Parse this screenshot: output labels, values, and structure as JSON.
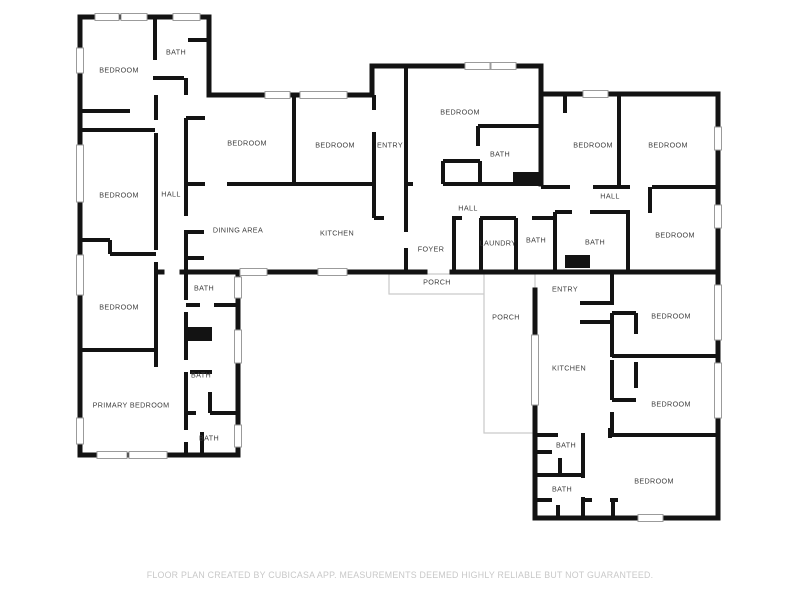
{
  "colors": {
    "wall": "#131313",
    "porch_outline": "#c9c9c9",
    "window_stroke": "#9b9b9b",
    "room_label": "#3d3d3d",
    "footer_text": "#c8c8c8"
  },
  "rooms": [
    {
      "label": "BEDROOM",
      "x": 119,
      "y": 70
    },
    {
      "label": "BATH",
      "x": 176,
      "y": 52
    },
    {
      "label": "BEDROOM",
      "x": 119,
      "y": 195
    },
    {
      "label": "HALL",
      "x": 171,
      "y": 194
    },
    {
      "label": "BEDROOM",
      "x": 247,
      "y": 143
    },
    {
      "label": "BEDROOM",
      "x": 335,
      "y": 145
    },
    {
      "label": "ENTRY",
      "x": 390,
      "y": 145
    },
    {
      "label": "BEDROOM",
      "x": 460,
      "y": 112
    },
    {
      "label": "BATH",
      "x": 500,
      "y": 154
    },
    {
      "label": "BEDROOM",
      "x": 593,
      "y": 145
    },
    {
      "label": "BEDROOM",
      "x": 668,
      "y": 145
    },
    {
      "label": "HALL",
      "x": 610,
      "y": 196
    },
    {
      "label": "HALL",
      "x": 468,
      "y": 208
    },
    {
      "label": "DINING AREA",
      "x": 238,
      "y": 230
    },
    {
      "label": "KITCHEN",
      "x": 337,
      "y": 233
    },
    {
      "label": "FOYER",
      "x": 431,
      "y": 249
    },
    {
      "label": "LAUNDRY",
      "x": 498,
      "y": 243
    },
    {
      "label": "BATH",
      "x": 536,
      "y": 240
    },
    {
      "label": "BATH",
      "x": 595,
      "y": 242
    },
    {
      "label": "BEDROOM",
      "x": 675,
      "y": 235
    },
    {
      "label": "BATH",
      "x": 204,
      "y": 288
    },
    {
      "label": "BEDROOM",
      "x": 119,
      "y": 307
    },
    {
      "label": "PORCH",
      "x": 437,
      "y": 282
    },
    {
      "label": "PORCH",
      "x": 506,
      "y": 317
    },
    {
      "label": "ENTRY",
      "x": 565,
      "y": 289
    },
    {
      "label": "BEDROOM",
      "x": 671,
      "y": 316
    },
    {
      "label": "KITCHEN",
      "x": 569,
      "y": 368
    },
    {
      "label": "BEDROOM",
      "x": 671,
      "y": 404
    },
    {
      "label": "BATH",
      "x": 201,
      "y": 375
    },
    {
      "label": "PRIMARY BEDROOM",
      "x": 131,
      "y": 405
    },
    {
      "label": "BATH",
      "x": 209,
      "y": 438
    },
    {
      "label": "BATH",
      "x": 566,
      "y": 445
    },
    {
      "label": "BATH",
      "x": 562,
      "y": 489
    },
    {
      "label": "BEDROOM",
      "x": 654,
      "y": 481
    }
  ],
  "footer": {
    "text": "FLOOR PLAN CREATED BY CUBICASA APP. MEASUREMENTS DEEMED HIGHLY RELIABLE BUT NOT GUARANTEED."
  }
}
